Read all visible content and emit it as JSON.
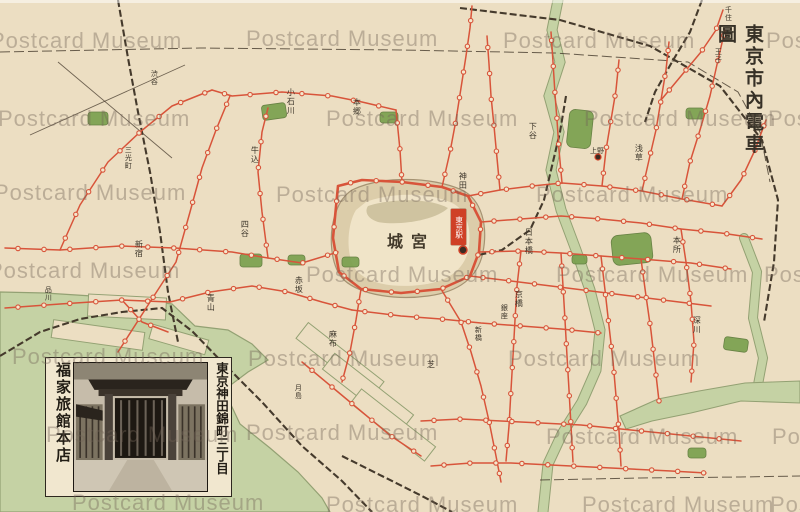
{
  "title": "東京市內電車圖",
  "watermark": {
    "text": "Postcard Museum",
    "instances": [
      {
        "x": -10,
        "y": 28
      },
      {
        "x": 246,
        "y": 26
      },
      {
        "x": 503,
        "y": 28
      },
      {
        "x": 766,
        "y": 28
      },
      {
        "x": -2,
        "y": 106
      },
      {
        "x": 326,
        "y": 106
      },
      {
        "x": 584,
        "y": 106
      },
      {
        "x": 768,
        "y": 106
      },
      {
        "x": -6,
        "y": 180
      },
      {
        "x": 276,
        "y": 182
      },
      {
        "x": 536,
        "y": 182
      },
      {
        "x": -12,
        "y": 258
      },
      {
        "x": 306,
        "y": 262
      },
      {
        "x": 556,
        "y": 262
      },
      {
        "x": 764,
        "y": 262
      },
      {
        "x": 12,
        "y": 344
      },
      {
        "x": 248,
        "y": 346
      },
      {
        "x": 508,
        "y": 346
      },
      {
        "x": 46,
        "y": 422
      },
      {
        "x": 246,
        "y": 420
      },
      {
        "x": 546,
        "y": 424
      },
      {
        "x": 772,
        "y": 424
      },
      {
        "x": 72,
        "y": 490
      },
      {
        "x": 326,
        "y": 492
      },
      {
        "x": 582,
        "y": 492
      },
      {
        "x": 770,
        "y": 492
      }
    ]
  },
  "map": {
    "palace_label": "宮城",
    "station_box_label": "東京駅",
    "labels": [
      {
        "t": "王子",
        "x": 714,
        "y": 48,
        "v": 1,
        "s": 7
      },
      {
        "t": "千住",
        "x": 724,
        "y": 6,
        "v": 1,
        "s": 7
      },
      {
        "t": "三光町",
        "x": 124,
        "y": 146,
        "v": 1,
        "s": 7
      },
      {
        "t": "渋谷",
        "x": 150,
        "y": 70,
        "v": 1,
        "s": 7
      },
      {
        "t": "上野",
        "x": 590,
        "y": 148,
        "v": 0,
        "s": 7
      },
      {
        "t": "月島",
        "x": 294,
        "y": 384,
        "v": 1,
        "s": 7
      },
      {
        "t": "品川",
        "x": 44,
        "y": 286,
        "v": 1,
        "s": 7
      },
      {
        "t": "新宿",
        "x": 134,
        "y": 240,
        "v": 1,
        "s": 8
      },
      {
        "t": "四谷",
        "x": 240,
        "y": 220,
        "v": 1,
        "s": 8
      },
      {
        "t": "牛込",
        "x": 250,
        "y": 146,
        "v": 1,
        "s": 8
      },
      {
        "t": "小石川",
        "x": 286,
        "y": 88,
        "v": 1,
        "s": 8
      },
      {
        "t": "本郷",
        "x": 352,
        "y": 98,
        "v": 1,
        "s": 8
      },
      {
        "t": "下谷",
        "x": 528,
        "y": 122,
        "v": 1,
        "s": 8
      },
      {
        "t": "浅草",
        "x": 634,
        "y": 144,
        "v": 1,
        "s": 8
      },
      {
        "t": "本所",
        "x": 672,
        "y": 236,
        "v": 1,
        "s": 8
      },
      {
        "t": "深川",
        "x": 692,
        "y": 316,
        "v": 1,
        "s": 8
      },
      {
        "t": "神田",
        "x": 458,
        "y": 172,
        "v": 1,
        "s": 8
      },
      {
        "t": "日本橋",
        "x": 524,
        "y": 228,
        "v": 1,
        "s": 8
      },
      {
        "t": "京橋",
        "x": 514,
        "y": 290,
        "v": 1,
        "s": 8
      },
      {
        "t": "芝",
        "x": 426,
        "y": 360,
        "v": 1,
        "s": 8
      },
      {
        "t": "麻布",
        "x": 328,
        "y": 330,
        "v": 1,
        "s": 8
      },
      {
        "t": "赤坂",
        "x": 294,
        "y": 276,
        "v": 1,
        "s": 8
      },
      {
        "t": "青山",
        "x": 206,
        "y": 294,
        "v": 1,
        "s": 8
      },
      {
        "t": "銀座",
        "x": 500,
        "y": 304,
        "v": 1,
        "s": 7
      },
      {
        "t": "新橋",
        "x": 474,
        "y": 326,
        "v": 1,
        "s": 7
      }
    ]
  },
  "inset": {
    "address": "東京神田錦町三丁目",
    "name": "福家旅館本店"
  },
  "colors": {
    "bg": "#ecdec2",
    "water": "#c5d2a4",
    "wedge": "#93a173",
    "park": "#7aa04e",
    "tram": "#d8543a",
    "rail": "#453a2c",
    "ink": "#3c352a",
    "moat": "#dccdaa",
    "medge": "#a59272",
    "wm": "rgba(115,100,88,0.40)",
    "red": "#cf4026",
    "station_fill": "#f4e8cd"
  }
}
